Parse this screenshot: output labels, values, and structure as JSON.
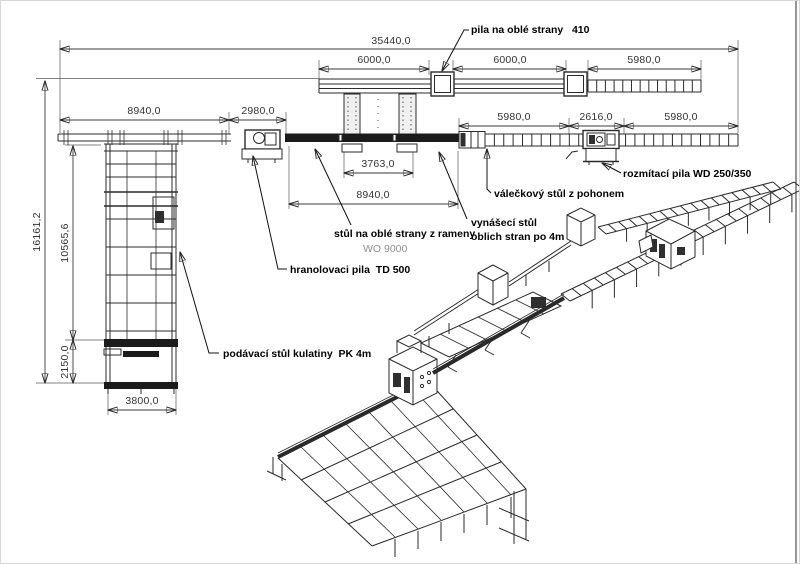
{
  "drawing": {
    "dims": {
      "total": "35440,0",
      "top1": "6000,0",
      "top2": "6000,0",
      "top3": "5980,0",
      "feed_len": "8940,0",
      "saw_gap": "2980,0",
      "right1": "5980,0",
      "right2": "2616,0",
      "right3": "5980,0",
      "table_inner": "3763,0",
      "table_len": "8940,0",
      "height_total": "16161,2",
      "height_mid": "10565,6",
      "height_bottom": "2150,0",
      "feed_width": "3800,0"
    },
    "labels": {
      "round_saw": "pila na oblé strany   410",
      "rip_saw": "rozmítací pila WD 250/350",
      "roller_table": "válečkový stůl z pohonem",
      "outfeed_line1": "vynášecí stůl",
      "outfeed_line2": "oblich stran po 4m",
      "arm_table": "stůl na oblé strany z rameny",
      "arm_table_model": "WO 9000",
      "beam_saw": "hranolovaci pila  TD 500",
      "log_infeed": "podávací stůl kulatiny  PK 4m"
    },
    "colors": {
      "line": "#2b2b2b",
      "dim": "#3a3a3a",
      "label": "#000000",
      "muted": "#8f8f8f",
      "dark_fill": "#1b1b1b"
    }
  }
}
